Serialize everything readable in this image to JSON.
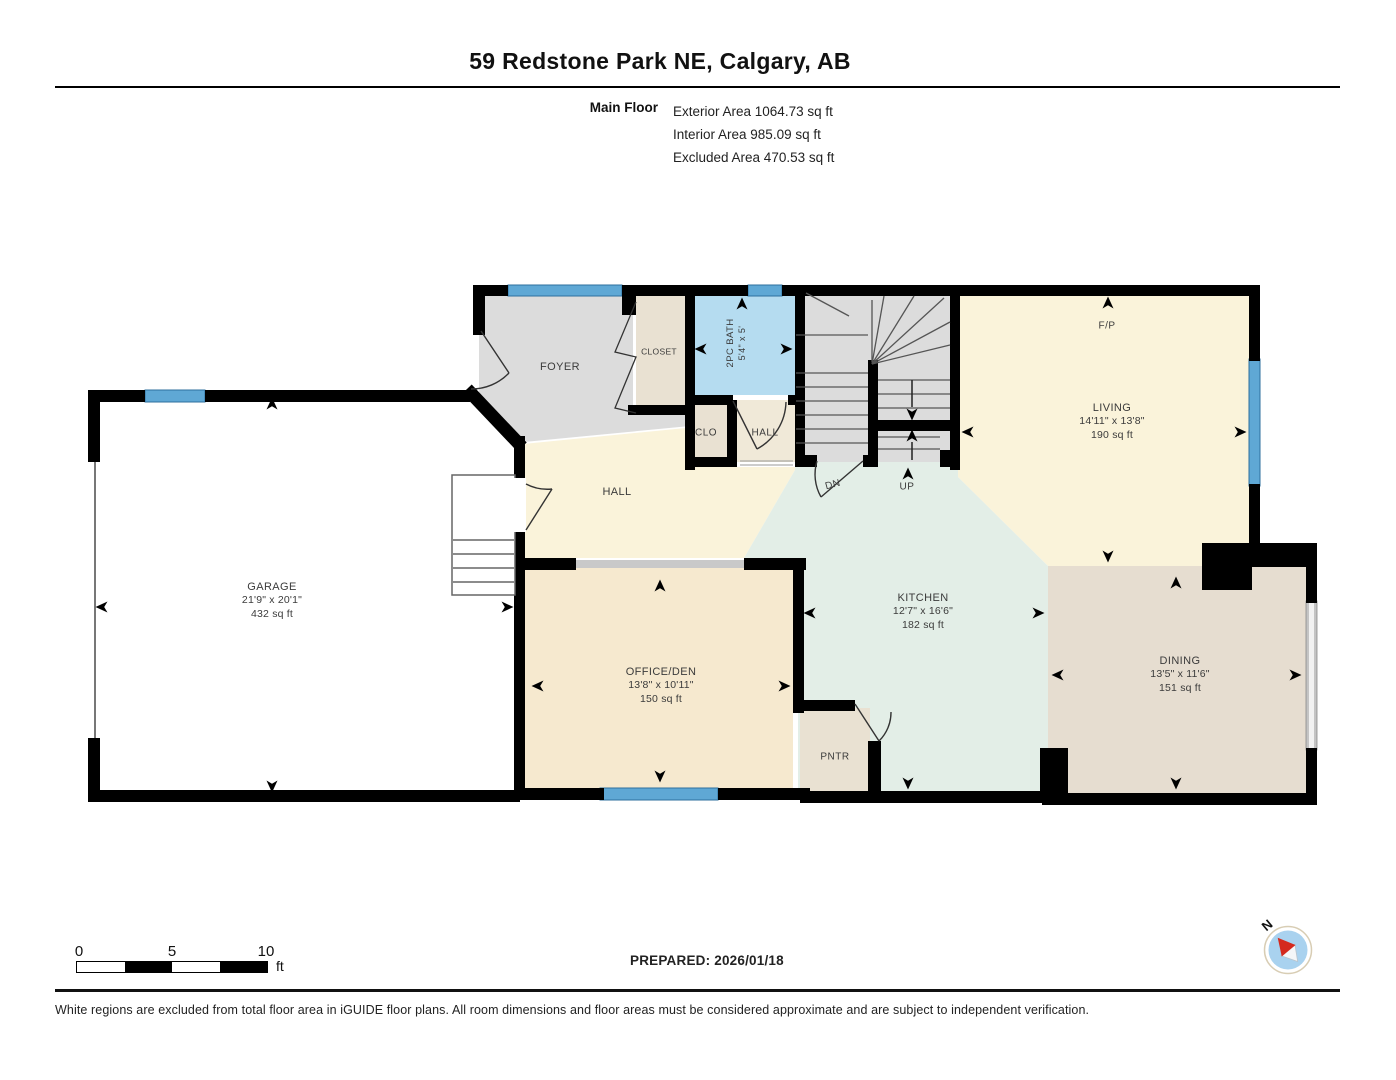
{
  "header": {
    "title": "59 Redstone Park NE, Calgary, AB",
    "floor_label": "Main Floor",
    "areas": [
      "Exterior Area 1064.73 sq ft",
      "Interior Area 985.09 sq ft",
      "Excluded Area 470.53 sq ft"
    ]
  },
  "rooms": {
    "foyer": {
      "name": "FOYER"
    },
    "closet": {
      "name": "CLOSET"
    },
    "bath": {
      "name": "2PC BATH",
      "dims": "5'4\" x 5'"
    },
    "clo": {
      "name": "CLO"
    },
    "hall_upper": {
      "name": "HALL"
    },
    "hall_main": {
      "name": "HALL"
    },
    "stairs": {
      "down": "DN",
      "up": "UP"
    },
    "fireplace": {
      "name": "F/P"
    },
    "living": {
      "name": "LIVING",
      "dims": "14'11\" x 13'8\"",
      "area": "190 sq ft"
    },
    "garage": {
      "name": "GARAGE",
      "dims": "21'9\" x 20'1\"",
      "area": "432 sq ft"
    },
    "office_den": {
      "name": "OFFICE/DEN",
      "dims": "13'8\" x 10'11\"",
      "area": "150 sq ft"
    },
    "kitchen": {
      "name": "KITCHEN",
      "dims": "12'7\" x 16'6\"",
      "area": "182 sq ft"
    },
    "pantry": {
      "name": "PNTR"
    },
    "dining": {
      "name": "DINING",
      "dims": "13'5\" x 11'6\"",
      "area": "151 sq ft"
    }
  },
  "scale_bar": {
    "ticks": [
      "0",
      "5",
      "10"
    ],
    "unit": "ft"
  },
  "compass": {
    "north_label": "N"
  },
  "footer": {
    "prepared": "PREPARED: 2026/01/18",
    "disclaimer": "White regions are excluded from total floor area in iGUIDE floor plans. All room dimensions and floor areas must be considered approximate and are subject to independent verification."
  },
  "colors": {
    "wall": "#000000",
    "window": "#5fa8d5",
    "room_gray": "#dcdcdc",
    "room_cream": "#faf3da",
    "room_tan": "#f6e9cf",
    "room_beige": "#e9e1d2",
    "room_dining": "#e6ddd0",
    "room_kitchen": "#e3eee7",
    "room_bath": "#b5dcf0",
    "opening_gray": "#c9c9c9",
    "compass_blue": "#a9d2ef",
    "compass_red": "#d42a1e"
  }
}
